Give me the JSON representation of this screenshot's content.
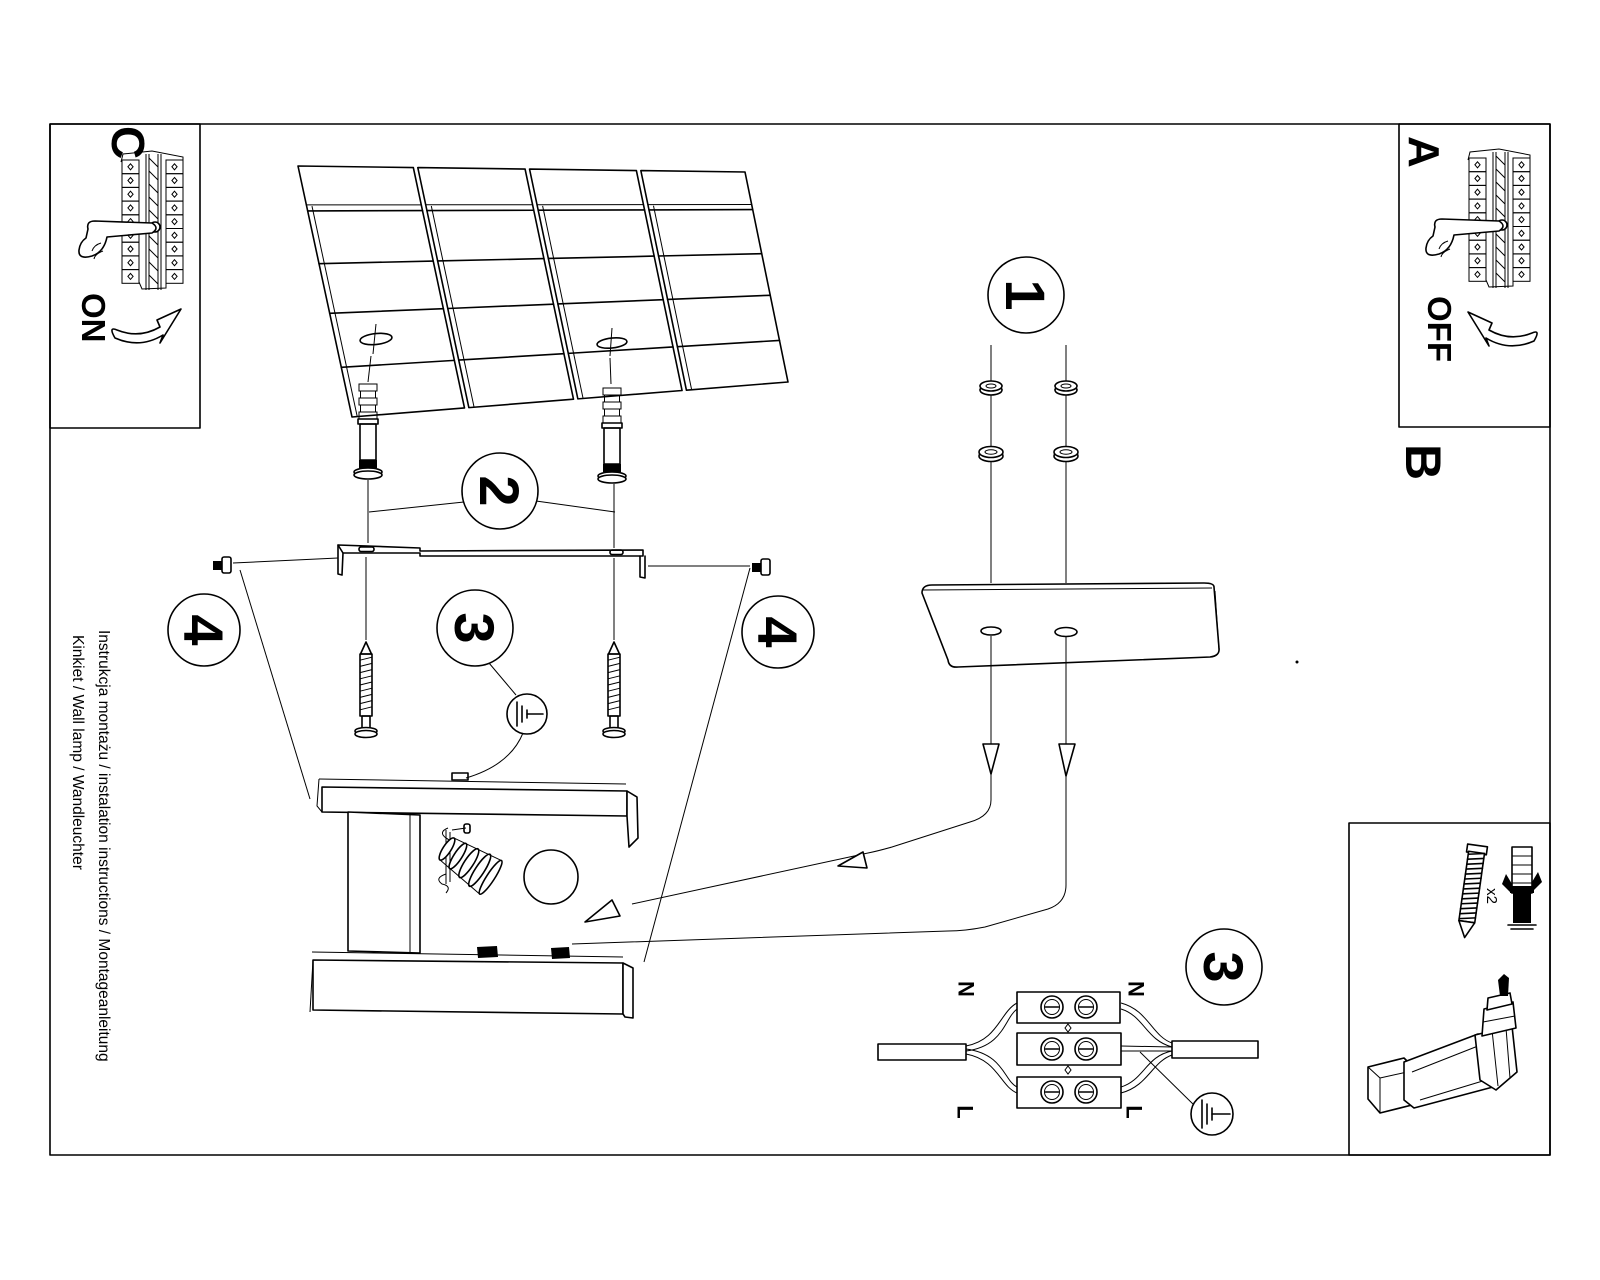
{
  "title": "Wall lamp installation instruction sheet",
  "colors": {
    "ink": "#000000",
    "paper": "#ffffff"
  },
  "margin_text": {
    "line1": "Instrukcja montażu / instalation instructions / Montageanleitung",
    "line2": "Kinkiet / Wall lamp / Wandleuchter"
  },
  "sections": {
    "panel_c": {
      "label": "C",
      "switch_state": "ON"
    },
    "panel_a": {
      "label": "A",
      "switch_state": "OFF"
    },
    "panel_b": {
      "label": "B"
    }
  },
  "steps": {
    "one": "1",
    "two": "2",
    "three": "3",
    "three_wiring": "3",
    "four_left": "4",
    "four_right": "4"
  },
  "wiring_labels": {
    "n_left": "N",
    "n_right": "N",
    "l_left": "L",
    "l_right": "L"
  },
  "parts": {
    "screw_anchor_qty": "x2"
  },
  "icons": {
    "breaker-hand-icon": "hand flipping circuit breaker switch",
    "curved-arrow-icon": "curved direction arrow",
    "earth-ground-icon": "protective earth symbol",
    "drill-icon": "cordless drill",
    "screw-icon": "mounting screw",
    "wall-plug-icon": "expansion wall plug",
    "washer-icon": "washer and nut",
    "bulb-icon": "light bulb"
  }
}
